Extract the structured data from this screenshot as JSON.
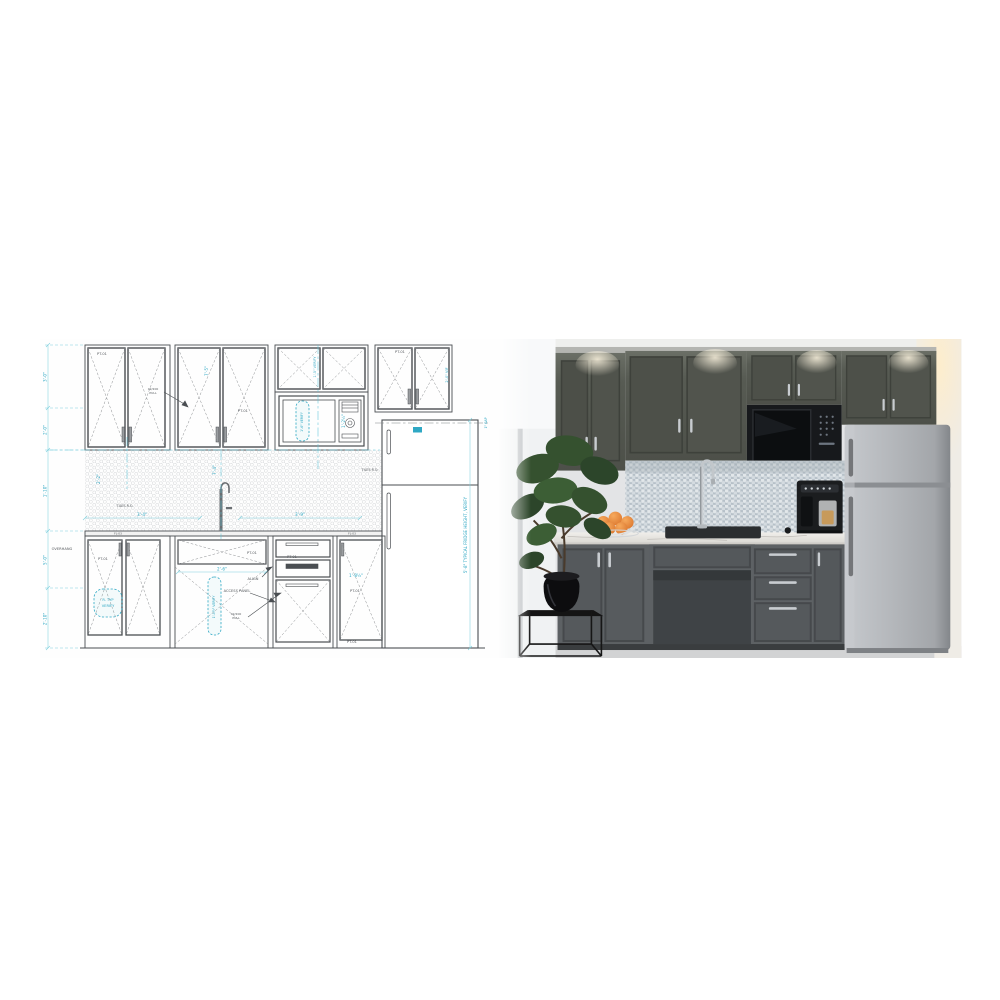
{
  "composite": {
    "description": "kitchen-elevation-blueprint-vs-rendered-photo",
    "blueprint": {
      "panel_tags": {
        "pt01": "PT-01",
        "fl03": "FL-03"
      },
      "notes": {
        "overhang": "OVERHANG",
        "tiles_ro": "TILES R.O.",
        "access_panel": "ACCESS PANEL",
        "align": "ALIGN",
        "pull_callout_line1": "02/200",
        "pull_callout_line2": "PULL",
        "fridge_height": "5'-8\" TYPICAL FRIDGE HEIGHT, VERIFY",
        "gap": "1\" GAP",
        "vif": "2'-0\" VIF",
        "mw_verify_v": "1'-5\" VERIFY"
      },
      "rev_clouds": {
        "typ_line1": "R. TYP",
        "typ_line2": "VERIFY",
        "microwave": "1'-6\" VERIFY",
        "access": "1'-4½\" VERIFY"
      },
      "dims": {
        "left_chain": [
          "3'-0\"",
          "2'-0\"",
          "1'-10\"",
          "5'-0\"",
          "2'-10\""
        ],
        "counter_left": "3'-4\"",
        "counter_right": "3'-9\"",
        "upper_height": "7'-5\"",
        "splash_height": "2'-2\"",
        "sink_center": "7'-4\"",
        "knee_width": "2'-6\"",
        "mw_height": "1'-2½\"",
        "base_door": "1'-8½\""
      },
      "colors": {
        "line": "#4a4e52",
        "cyan": "#2fa8c4",
        "dim_line": "#7ecfdd",
        "hatch_dot": "#cfd2d4"
      }
    },
    "photo": {
      "objects": [
        "window",
        "house-plant",
        "plant-stand",
        "upper-cabinets",
        "microwave",
        "penny-tile-backsplash",
        "marble-countertop",
        "gooseneck-faucet",
        "undermount-sink",
        "fruit-bowl-oranges",
        "espresso-machine",
        "base-cabinets",
        "drawer-bank",
        "refrigerator"
      ],
      "colors": {
        "wall": "#e3e4e6",
        "cabinet": "#585c55",
        "cabinet_dark": "#4b4f49",
        "counter": "#e9e7e2",
        "steel": "#aeb2b6",
        "microwave": "#17191c",
        "orange": "#e8873a",
        "leaf": "#35512f",
        "tile": "#c7d0d6",
        "floor": "#d2d3d4"
      }
    }
  }
}
